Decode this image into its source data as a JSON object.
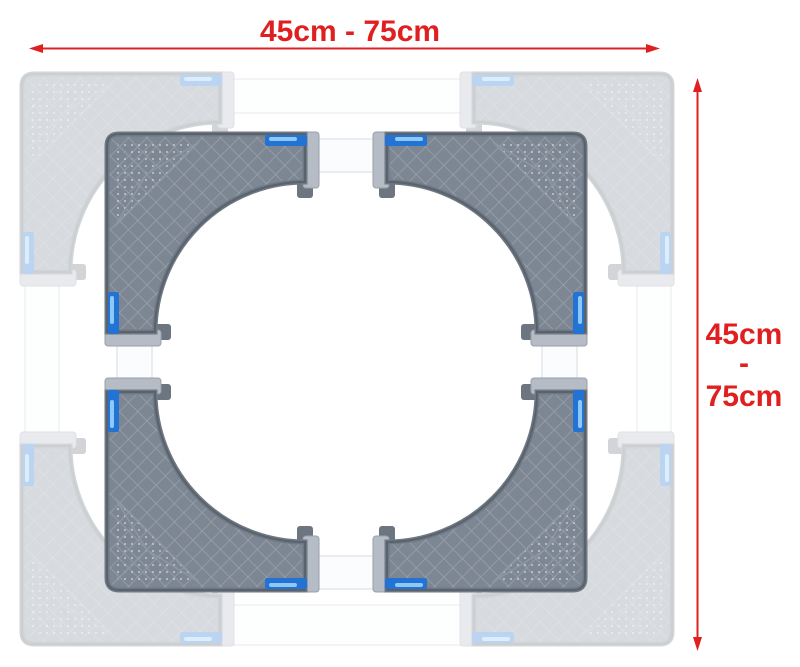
{
  "diagram": {
    "title": "adjustable appliance base frame with four corner pads",
    "accent_color": "#e02020",
    "annotations": {
      "top_dimension": {
        "label": "45cm - 75cm"
      },
      "right_dimension": {
        "label": "45cm - 75cm",
        "lines": [
          "45cm",
          "-",
          "75cm"
        ]
      }
    },
    "product": {
      "corner_pad_count": 4,
      "ghost_opacity": 0.3,
      "colors": {
        "pad_base": "#7d8793",
        "pad_rim": "#59626d",
        "pad_edge_band": "#6f7984",
        "pad_end_cap": "#b5bcc6",
        "slider_blue": "#2273d4",
        "slider_highlight": "#8ec9f5",
        "tube_fill": "#fbfcfd",
        "tube_edge": "#e4e7eb"
      }
    }
  }
}
